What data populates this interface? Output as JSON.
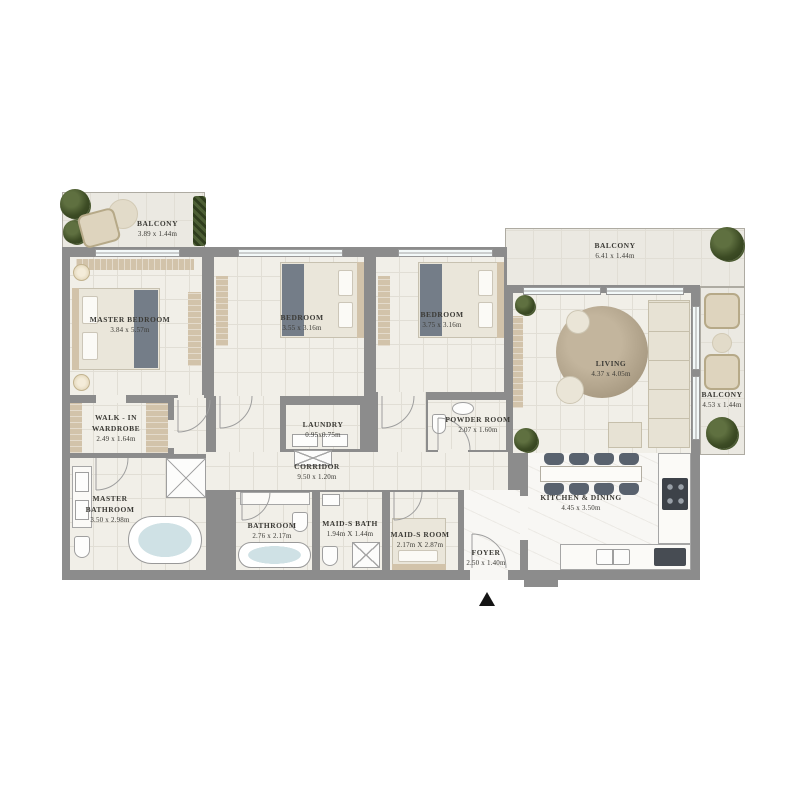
{
  "rooms": [
    {
      "id": "balcony-top-left",
      "label": "BALCONY",
      "dims": "3.89 x 1.44m"
    },
    {
      "id": "master-bedroom",
      "label": "MASTER BEDROOM",
      "dims": "3.84 x 5.57m"
    },
    {
      "id": "bedroom-2",
      "label": "BEDROOM",
      "dims": "3.55 x 3.16m"
    },
    {
      "id": "bedroom-3",
      "label": "BEDROOM",
      "dims": "3.75 x 3.16m"
    },
    {
      "id": "balcony-top-right",
      "label": "BALCONY",
      "dims": "6.41 x 1.44m"
    },
    {
      "id": "living",
      "label": "LIVING",
      "dims": "4.37 x 4.05m"
    },
    {
      "id": "balcony-right",
      "label": "BALCONY",
      "dims": "4.53 x 1.44m"
    },
    {
      "id": "walk-in-wardrobe",
      "label": "WALK - IN WARDROBE",
      "dims": "2.49 x 1.64m"
    },
    {
      "id": "laundry",
      "label": "LAUNDRY",
      "dims": "0.95x0.75m"
    },
    {
      "id": "powder-room",
      "label": "POWDER ROOM",
      "dims": "2.07 x 1.60m"
    },
    {
      "id": "corridor",
      "label": "CORRIDOR",
      "dims": "9.50 x 1.20m"
    },
    {
      "id": "master-bathroom",
      "label": "MASTER BATHROOM",
      "dims": "3.50 x 2.98m"
    },
    {
      "id": "bathroom",
      "label": "BATHROOM",
      "dims": "2.76 x 2.17m"
    },
    {
      "id": "maids-bath",
      "label": "MAID-S BATH",
      "dims": "1.94m X 1.44m"
    },
    {
      "id": "maids-room",
      "label": "MAID-S ROOM",
      "dims": "2.17m X 2.87m"
    },
    {
      "id": "foyer",
      "label": "FOYER",
      "dims": "2.50 x 1.40m"
    },
    {
      "id": "kitchen-dining",
      "label": "KITCHEN & DINING",
      "dims": "4.45 x 3.50m"
    }
  ],
  "entrance_marker": {
    "symbol": "▲"
  },
  "colors": {
    "wall": "#8c8c8c",
    "floor": "#f1efe8",
    "balcony": "#ebe9e2",
    "marble": "#f8f7f4",
    "grid": "#e1ded5",
    "wood": "#d2c3aa",
    "green": "#41502c",
    "textc": "#3b3a35",
    "bedding": "#eae6da",
    "throw": "#747d88",
    "rug": "#ab9d85",
    "sofa": "#e7e2d4",
    "chairdark": "#59626e",
    "water": "#cfe1e5"
  }
}
